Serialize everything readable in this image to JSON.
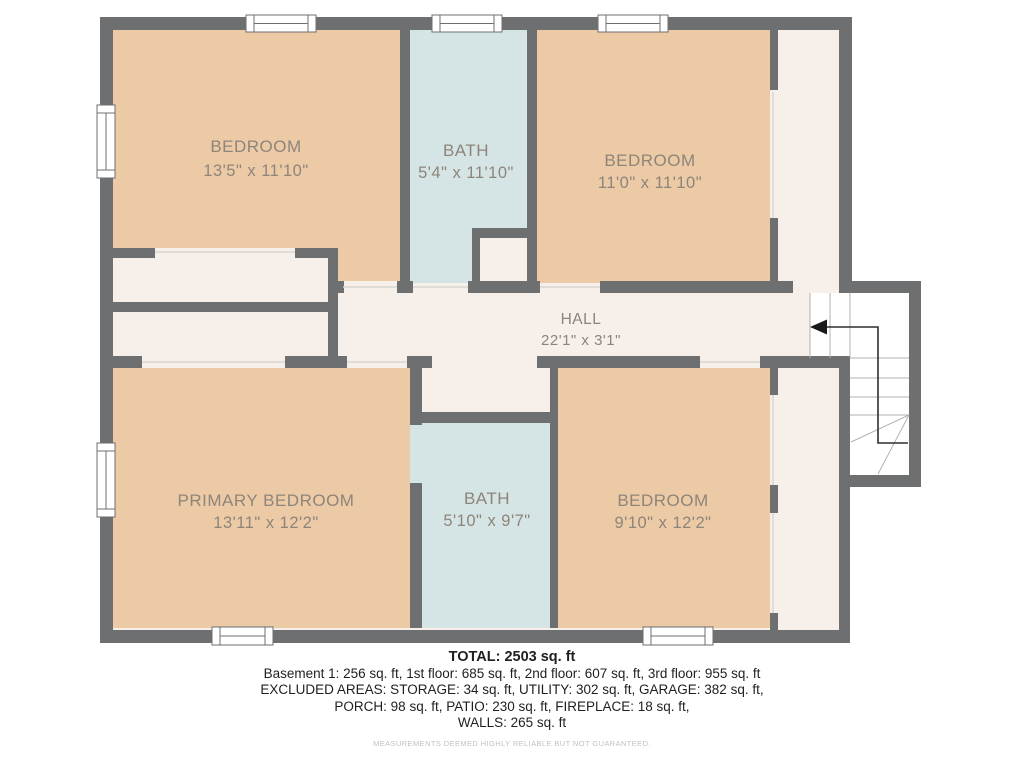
{
  "colors": {
    "wall": "#6d6f71",
    "bedroom": "#edcaa6",
    "bath": "#d5e4e4",
    "hall": "#f6efea",
    "stairs": "#ffffff",
    "label": "#8d857a",
    "summary_text": "#1f1f1f",
    "disclaimer": "#c4c1bd",
    "arrow": "#1a1a1a",
    "door_line": "#d9d5d1",
    "tread": "#b4b2af"
  },
  "rooms": [
    {
      "id": "bedroom-1",
      "name": "BEDROOM",
      "dims": "13'5\" x 11'10\""
    },
    {
      "id": "bath-1",
      "name": "BATH",
      "dims": "5'4\" x 11'10\""
    },
    {
      "id": "bedroom-2",
      "name": "BEDROOM",
      "dims": "11'0\" x 11'10\""
    },
    {
      "id": "hall",
      "name": "HALL",
      "dims": "22'1\" x 3'1\""
    },
    {
      "id": "primary-bedroom",
      "name": "PRIMARY BEDROOM",
      "dims": "13'11\" x 12'2\""
    },
    {
      "id": "bath-2",
      "name": "BATH",
      "dims": "5'10\" x 9'7\""
    },
    {
      "id": "bedroom-3",
      "name": "BEDROOM",
      "dims": "9'10\" x 12'2\""
    }
  ],
  "summary": {
    "total": "TOTAL: 2503 sq. ft",
    "lines": [
      "Basement 1: 256 sq. ft, 1st floor: 685 sq. ft, 2nd floor: 607 sq. ft, 3rd floor: 955 sq. ft",
      "EXCLUDED AREAS: STORAGE: 34 sq. ft, UTILITY: 302 sq. ft, GARAGE: 382 sq. ft,",
      "PORCH: 98 sq. ft, PATIO: 230 sq. ft, FIREPLACE: 18 sq. ft,",
      "WALLS: 265 sq. ft"
    ],
    "disclaimer": "MEASUREMENTS DEEMED HIGHLY RELIABLE BUT NOT GUARANTEED."
  }
}
